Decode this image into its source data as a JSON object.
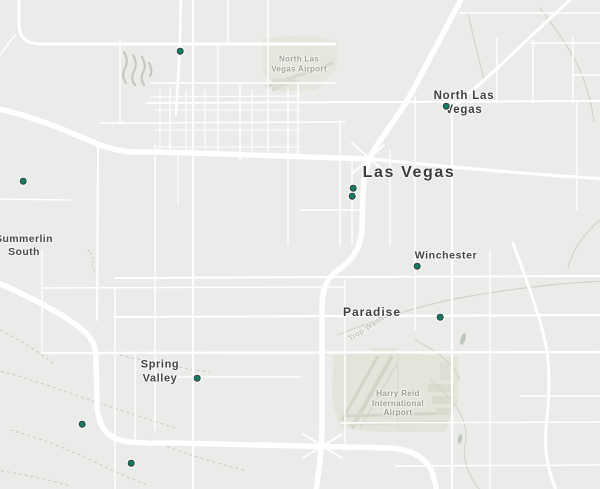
{
  "map": {
    "background_color": "#ebebe9",
    "road_color": "#ffffff",
    "marker_style": {
      "fill": "#0c7e62",
      "ring": "#39423e",
      "halo": "#ffffff"
    },
    "labels": [
      {
        "id": "north-las-vegas-airport",
        "lines": [
          "North Las",
          "Vegas Airport"
        ],
        "x": 299,
        "y": 64,
        "size": 8,
        "color": "#a3a399",
        "weight": 600,
        "spacing": 0.3,
        "line_height": 9.5
      },
      {
        "id": "north-las-vegas",
        "lines": [
          "North Las",
          "Vegas"
        ],
        "x": 464,
        "y": 103,
        "size": 11.5,
        "color": "#3e3e3e",
        "weight": 600,
        "spacing": 0.8,
        "line_height": 14
      },
      {
        "id": "las-vegas",
        "lines": [
          "Las Vegas"
        ],
        "x": 409,
        "y": 173,
        "size": 16,
        "color": "#3c3c3c",
        "weight": 600,
        "spacing": 1.6,
        "line_height": 18
      },
      {
        "id": "summerlin-south",
        "lines": [
          "Summerlin",
          "South"
        ],
        "x": 24,
        "y": 246,
        "size": 10.5,
        "color": "#4a4a4a",
        "weight": 600,
        "spacing": 0.4,
        "line_height": 13
      },
      {
        "id": "winchester",
        "lines": [
          "Winchester"
        ],
        "x": 446,
        "y": 256,
        "size": 10.5,
        "color": "#434343",
        "weight": 600,
        "spacing": 0.6,
        "line_height": 13
      },
      {
        "id": "paradise",
        "lines": [
          "Paradise"
        ],
        "x": 372,
        "y": 312,
        "size": 12,
        "color": "#3f3f3f",
        "weight": 600,
        "spacing": 1,
        "line_height": 14
      },
      {
        "id": "spring-valley",
        "lines": [
          "Spring",
          "Valley"
        ],
        "x": 160,
        "y": 372,
        "size": 11,
        "color": "#454545",
        "weight": 600,
        "spacing": 0.6,
        "line_height": 13.5
      },
      {
        "id": "harry-reid-international-airport",
        "lines": [
          "Harry Reid",
          "International",
          "Airport"
        ],
        "x": 398,
        "y": 403,
        "size": 8,
        "color": "#9d9d92",
        "weight": 600,
        "spacing": 0.3,
        "line_height": 9.5
      },
      {
        "id": "trop-wash",
        "lines": [
          "Trop Wash"
        ],
        "x": 366,
        "y": 328,
        "size": 7.5,
        "color": "#a9aca2",
        "weight": 400,
        "spacing": 0.5,
        "line_height": 9,
        "rotate": -33
      }
    ],
    "markers": [
      {
        "id": "marker-1",
        "x": 180,
        "y": 51
      },
      {
        "id": "marker-2",
        "x": 23,
        "y": 181
      },
      {
        "id": "marker-3",
        "x": 446,
        "y": 106
      },
      {
        "id": "marker-4",
        "x": 353,
        "y": 188
      },
      {
        "id": "marker-5",
        "x": 352,
        "y": 196
      },
      {
        "id": "marker-6",
        "x": 417,
        "y": 266
      },
      {
        "id": "marker-7",
        "x": 440,
        "y": 317
      },
      {
        "id": "marker-8",
        "x": 197,
        "y": 378
      },
      {
        "id": "marker-9",
        "x": 82,
        "y": 424
      },
      {
        "id": "marker-10",
        "x": 131,
        "y": 463
      }
    ]
  }
}
